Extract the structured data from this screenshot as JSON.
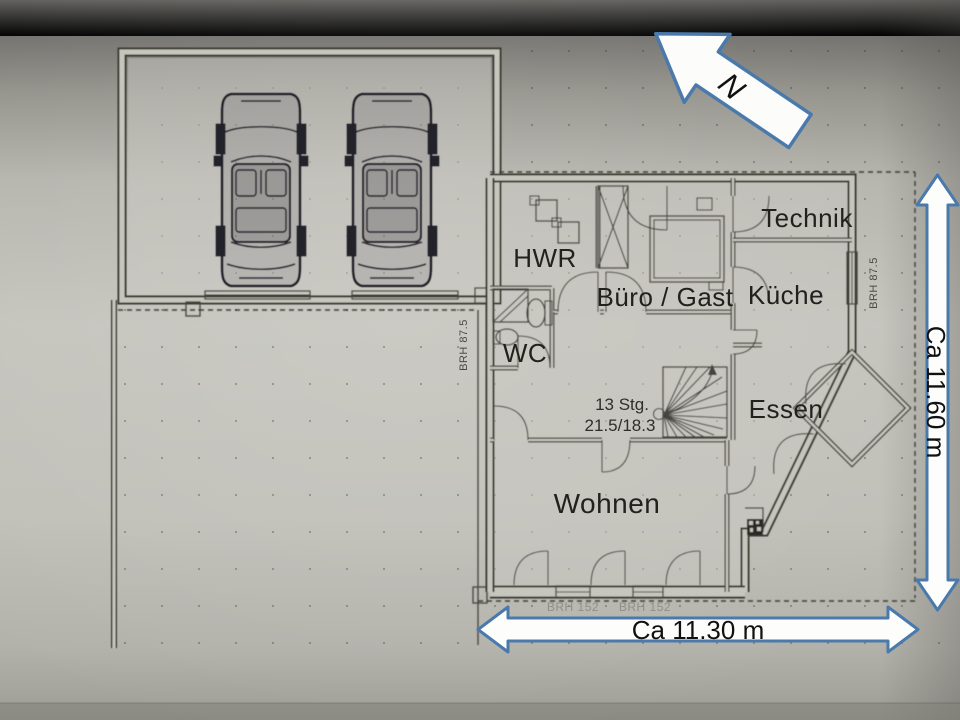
{
  "north_arrow": {
    "label": "N"
  },
  "rooms": [
    {
      "id": "hwr",
      "label": "HWR"
    },
    {
      "id": "buero",
      "label": "Büro / Gast"
    },
    {
      "id": "technik",
      "label": "Technik"
    },
    {
      "id": "kueche",
      "label": "Küche"
    },
    {
      "id": "wc",
      "label": "WC"
    },
    {
      "id": "essen",
      "label": "Essen"
    },
    {
      "id": "wohnen",
      "label": "Wohnen"
    }
  ],
  "stairs_note": {
    "line1": "13 Stg.",
    "line2": "21.5/18.3"
  },
  "dimensions": {
    "horizontal": "Ca 11.30 m",
    "vertical": "Ca 11.60 m"
  },
  "sill_notes": {
    "left": "BRH 87.5",
    "right": "BRH 87.5",
    "bottom_1": "BRH 152",
    "bottom_2": "BRH 152"
  },
  "colors": {
    "paper": "#c3c2bb",
    "ink": "#3a3a34",
    "dimension_arrow_fill": "#fdfdfc",
    "dimension_arrow_border": "#4a79ab",
    "car_ink": "#1f1f28"
  }
}
